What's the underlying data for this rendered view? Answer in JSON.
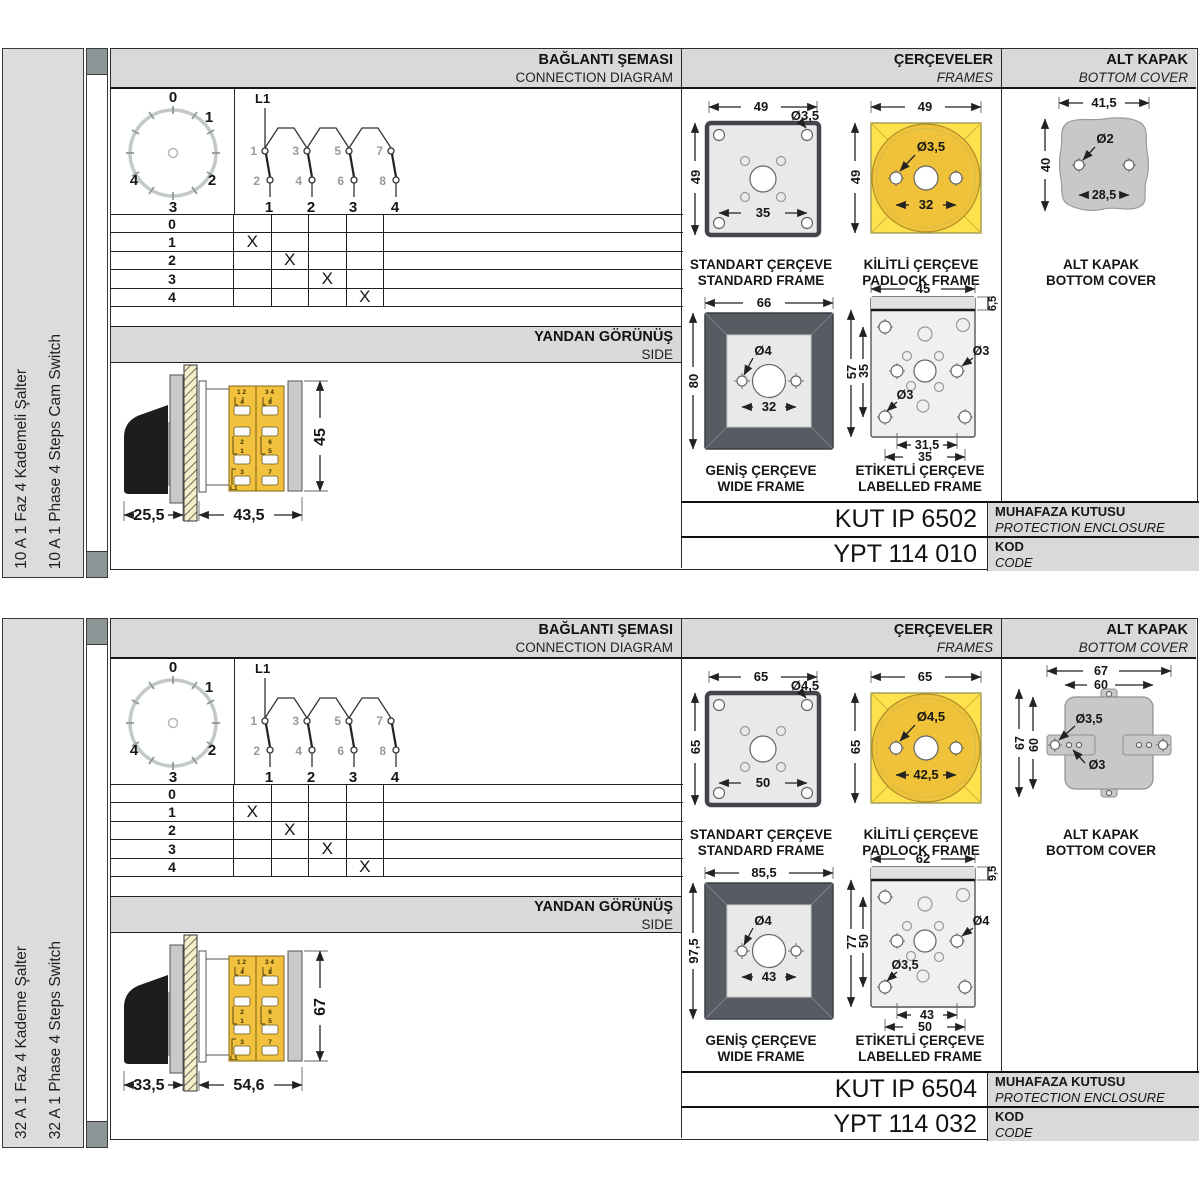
{
  "colors": {
    "accent_yellow": "#F2C13E",
    "padlock_yellow": "#FFE14E",
    "padlock_circle": "#EFC23A",
    "band_gray": "#D9D9D9",
    "frame_dark": "#575C63",
    "cover_gray": "#C8C8C8",
    "strip_square": "#8C9697"
  },
  "panels": [
    {
      "sidebar": {
        "tr": "10 A 1 Faz 4 Kademeli Şalter",
        "en": "10 A 1 Phase 4 Steps Cam Switch"
      },
      "headers": {
        "connection_tr": "BAĞLANTI ŞEMASI",
        "connection_en": "CONNECTION DIAGRAM",
        "frames_tr": "ÇERÇEVELER",
        "frames_en": "FRAMES",
        "cover_tr": "ALT KAPAK",
        "cover_en": "BOTTOM COVER"
      },
      "side_header": {
        "tr": "YANDAN GÖRÜNÜŞ",
        "en": "SIDE"
      },
      "dial": {
        "labels": [
          "0",
          "1",
          "2",
          "3",
          "4"
        ]
      },
      "schematic": {
        "feed": "L1",
        "top_terminals": [
          "1",
          "3",
          "5",
          "7"
        ],
        "bottom_terminals": [
          "2",
          "4",
          "6",
          "8"
        ],
        "contacts": [
          "1",
          "2",
          "3",
          "4"
        ]
      },
      "position_table": {
        "rows": [
          {
            "label": "0",
            "marks": [
              "",
              "",
              "",
              ""
            ]
          },
          {
            "label": "1",
            "marks": [
              "X",
              "",
              "",
              ""
            ]
          },
          {
            "label": "2",
            "marks": [
              "",
              "X",
              "",
              ""
            ]
          },
          {
            "label": "3",
            "marks": [
              "",
              "",
              "X",
              ""
            ]
          },
          {
            "label": "4",
            "marks": [
              "",
              "",
              "",
              "X"
            ]
          }
        ]
      },
      "side_view": {
        "depth_front": "25,5",
        "depth_body": "43,5",
        "height": "45",
        "body": {
          "col1_top": "1 2",
          "col1_cells": [
            "4",
            "2",
            "1",
            "3"
          ],
          "col2_top": "3 4",
          "col2_cells": [
            "8",
            "6",
            "5",
            "7"
          ],
          "feed": "L1"
        }
      },
      "frames": {
        "standard": {
          "w": "49",
          "h": "49",
          "hole": "Ø3,5",
          "inner": "35",
          "tr": "STANDART ÇERÇEVE",
          "en": "STANDARD FRAME"
        },
        "padlock": {
          "w": "49",
          "h": "49",
          "hole": "Ø3,5",
          "span": "32",
          "tr": "KİLİTLİ ÇERÇEVE",
          "en": "PADLOCK FRAME"
        },
        "wide": {
          "w": "66",
          "h": "80",
          "hole": "Ø4",
          "span": "32",
          "tr": "GENİŞ ÇERÇEVE",
          "en": "WIDE FRAME"
        },
        "labelled": {
          "w": "45",
          "strip": "6,5",
          "h_outer": "57",
          "h_inner": "35",
          "hole_right": "Ø3",
          "hole_left": "Ø3",
          "span_inner": "31,5",
          "span_outer": "35",
          "tr": "ETİKETLİ ÇERÇEVE",
          "en": "LABELLED FRAME"
        }
      },
      "cover": {
        "tr": "ALT KAPAK",
        "en": "BOTTOM COVER",
        "w": "41,5",
        "h": "40",
        "hole": "Ø2",
        "span": "28,5"
      },
      "enclosure": {
        "value": "KUT IP 6502",
        "label_tr": "MUHAFAZA KUTUSU",
        "label_en": "PROTECTION ENCLOSURE"
      },
      "code": {
        "value": "YPT 114 010",
        "label_tr": "KOD",
        "label_en": "CODE"
      }
    },
    {
      "sidebar": {
        "tr": "32 A 1 Faz 4 Kademe Şalter",
        "en": "32 A 1 Phase 4 Steps Switch"
      },
      "headers": {
        "connection_tr": "BAĞLANTI ŞEMASI",
        "connection_en": "CONNECTION DIAGRAM",
        "frames_tr": "ÇERÇEVELER",
        "frames_en": "FRAMES",
        "cover_tr": "ALT KAPAK",
        "cover_en": "BOTTOM COVER"
      },
      "side_header": {
        "tr": "YANDAN GÖRÜNÜŞ",
        "en": "SIDE"
      },
      "dial": {
        "labels": [
          "0",
          "1",
          "2",
          "3",
          "4"
        ]
      },
      "schematic": {
        "feed": "L1",
        "top_terminals": [
          "1",
          "3",
          "5",
          "7"
        ],
        "bottom_terminals": [
          "2",
          "4",
          "6",
          "8"
        ],
        "contacts": [
          "1",
          "2",
          "3",
          "4"
        ]
      },
      "position_table": {
        "rows": [
          {
            "label": "0",
            "marks": [
              "",
              "",
              "",
              ""
            ]
          },
          {
            "label": "1",
            "marks": [
              "X",
              "",
              "",
              ""
            ]
          },
          {
            "label": "2",
            "marks": [
              "",
              "X",
              "",
              ""
            ]
          },
          {
            "label": "3",
            "marks": [
              "",
              "",
              "X",
              ""
            ]
          },
          {
            "label": "4",
            "marks": [
              "",
              "",
              "",
              "X"
            ]
          }
        ]
      },
      "side_view": {
        "depth_front": "33,5",
        "depth_body": "54,6",
        "height": "67",
        "body": {
          "col1_top": "1 2",
          "col1_cells": [
            "4",
            "2",
            "1",
            "3"
          ],
          "col2_top": "3 4",
          "col2_cells": [
            "8",
            "6",
            "5",
            "7"
          ],
          "feed": "L1"
        }
      },
      "frames": {
        "standard": {
          "w": "65",
          "h": "65",
          "hole": "Ø4,5",
          "inner": "50",
          "tr": "STANDART ÇERÇEVE",
          "en": "STANDARD FRAME"
        },
        "padlock": {
          "w": "65",
          "h": "65",
          "hole": "Ø4,5",
          "span": "42,5",
          "tr": "KİLİTLİ ÇERÇEVE",
          "en": "PADLOCK FRAME"
        },
        "wide": {
          "w": "85,5",
          "h": "97,5",
          "hole": "Ø4",
          "span": "43",
          "tr": "GENİŞ ÇERÇEVE",
          "en": "WIDE FRAME"
        },
        "labelled": {
          "w": "62",
          "strip": "9,5",
          "h_outer": "77",
          "h_inner": "50",
          "hole_right": "Ø4",
          "hole_left": "Ø3,5",
          "span_inner": "43",
          "span_outer": "50",
          "tr": "ETİKETLİ ÇERÇEVE",
          "en": "LABELLED FRAME"
        }
      },
      "cover": {
        "tr": "ALT KAPAK",
        "en": "BOTTOM COVER",
        "w_outer": "67",
        "w_inner": "60",
        "h_outer": "67",
        "h_inner": "60",
        "hole_large": "Ø3,5",
        "hole_small": "Ø3"
      },
      "enclosure": {
        "value": "KUT IP 6504",
        "label_tr": "MUHAFAZA KUTUSU",
        "label_en": "PROTECTION ENCLOSURE"
      },
      "code": {
        "value": "YPT 114 032",
        "label_tr": "KOD",
        "label_en": "CODE"
      }
    }
  ]
}
